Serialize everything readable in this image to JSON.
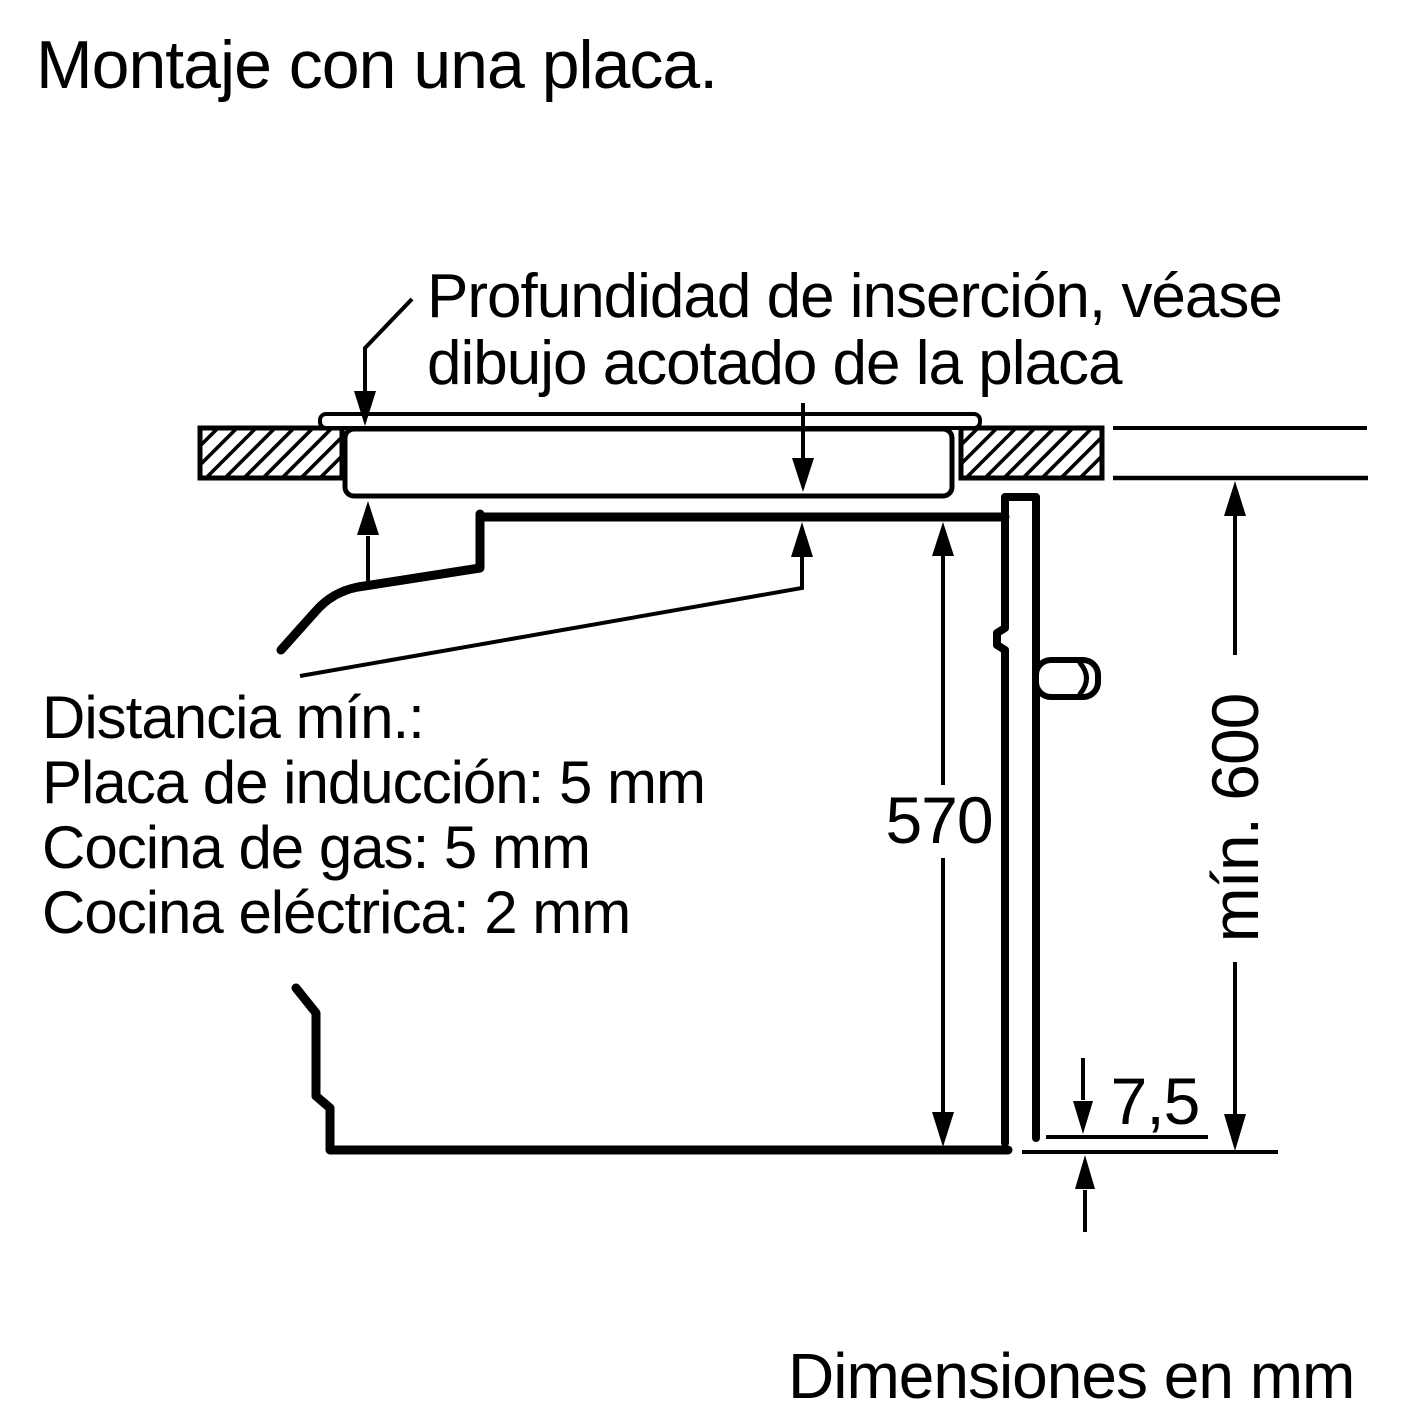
{
  "title": "Montaje con una placa.",
  "footer": "Dimensiones en mm",
  "callouts": {
    "insertion_depth": {
      "line1": "Profundidad de inserción, véase",
      "line2": "dibujo acotado de la placa"
    },
    "min_distance": {
      "line1": "Distancia mín.:",
      "line2": "Placa de inducción: 5 mm",
      "line3": "Cocina de gas: 5 mm",
      "line4": "Cocina eléctrica: 2 mm"
    }
  },
  "dimensions": {
    "oven_height": "570",
    "niche_height": "mín. 600",
    "door_floor_gap": "7,5"
  },
  "colors": {
    "ink": "#000000",
    "background": "#ffffff"
  }
}
